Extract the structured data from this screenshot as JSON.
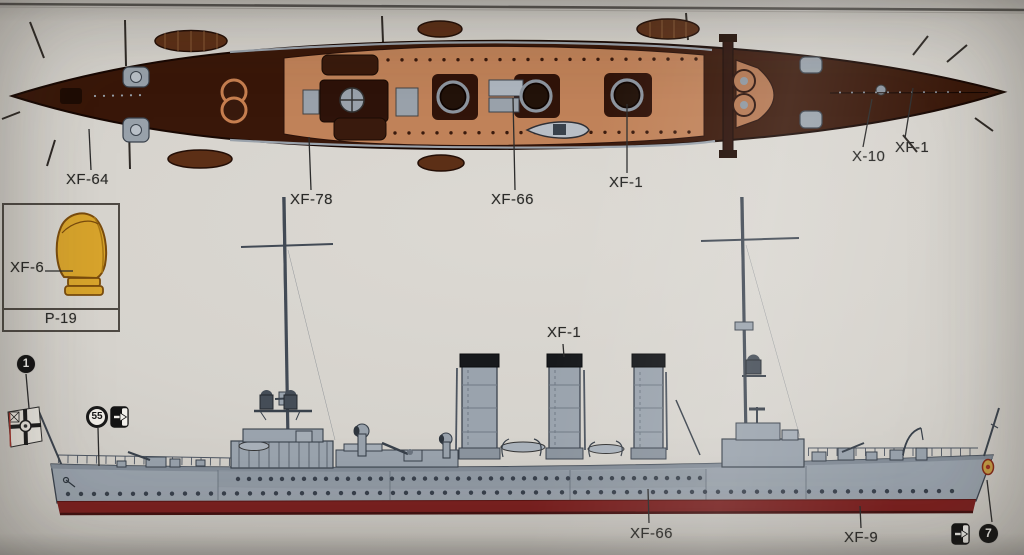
{
  "colors": {
    "paper": "#d6d3cd",
    "top_hull_brown": "#3a1708",
    "wood_deck_tan": "#c28257",
    "aft_deck_tan": "#b5764e",
    "ship_grey": "#99a2ac",
    "funnel_cap_black": "#16181b",
    "waterline_red": "#7f1f1e",
    "ventilator_yellow": "#d8a42c",
    "label_ink": "#2a2a28"
  },
  "top_view": {
    "labels": {
      "bow_hull": "XF-64",
      "wood_deck": "XF-78",
      "structure": "XF-66",
      "funnel_top": "XF-1",
      "stern_deck_a": "X-10",
      "stern_deck_b": "XF-1"
    }
  },
  "inset": {
    "paint_label": "XF-6",
    "part_label": "P-19"
  },
  "side_view": {
    "labels": {
      "funnel_cap": "XF-1",
      "hull_side": "XF-66",
      "waterline": "XF-9"
    },
    "markers": {
      "flag_part": "1",
      "hull_decal": "55",
      "stern_decal": "7"
    }
  }
}
